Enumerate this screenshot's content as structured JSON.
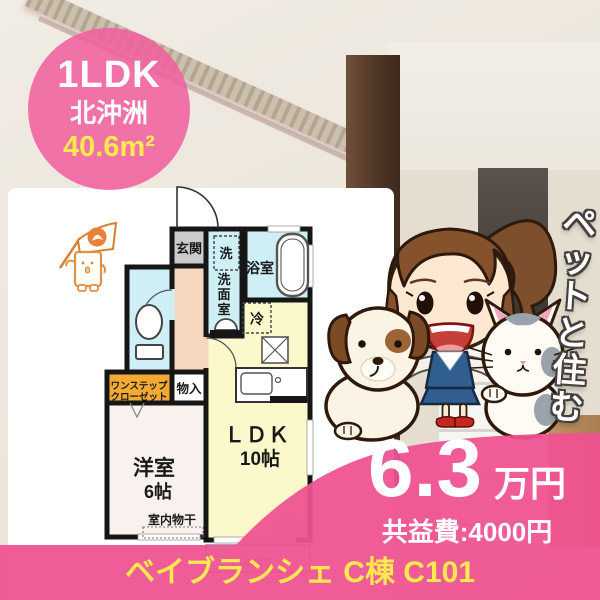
{
  "badge": {
    "layout": "1LDK",
    "district": "北沖洲",
    "area": "40.6m²"
  },
  "floorplan": {
    "genkan": "玄関",
    "washer": "洗",
    "senmen_chars": [
      "洗",
      "面",
      "室"
    ],
    "bath": "浴室",
    "fridge": "冷",
    "ldk_name": "ＬＤＫ",
    "ldk_size": "10帖",
    "western_room": "洋室",
    "western_size": "6帖",
    "closet_line1": "ワンステップ",
    "closet_line2": "クローゼット",
    "storage": "物入",
    "indoor_drying": "室内物干",
    "ac_label": "AC",
    "balcony": "バルコニー"
  },
  "promo": {
    "vertical_text": "ペットと住む"
  },
  "price": {
    "rent": "6.3",
    "rent_unit": "万円",
    "common_fee": "共益費:4000円"
  },
  "footer": {
    "building_name": "ベイブランシェ C棟 C101"
  },
  "colors": {
    "pink_badge": "#F0619D",
    "pink_band": "#EF5290",
    "accent_yellow": "#FFE94F",
    "plan_blue": "#CDEFF5",
    "plan_yellow": "#FBF8CB",
    "plan_peach": "#F6D7BE",
    "closet_orange": "#F3A933"
  }
}
